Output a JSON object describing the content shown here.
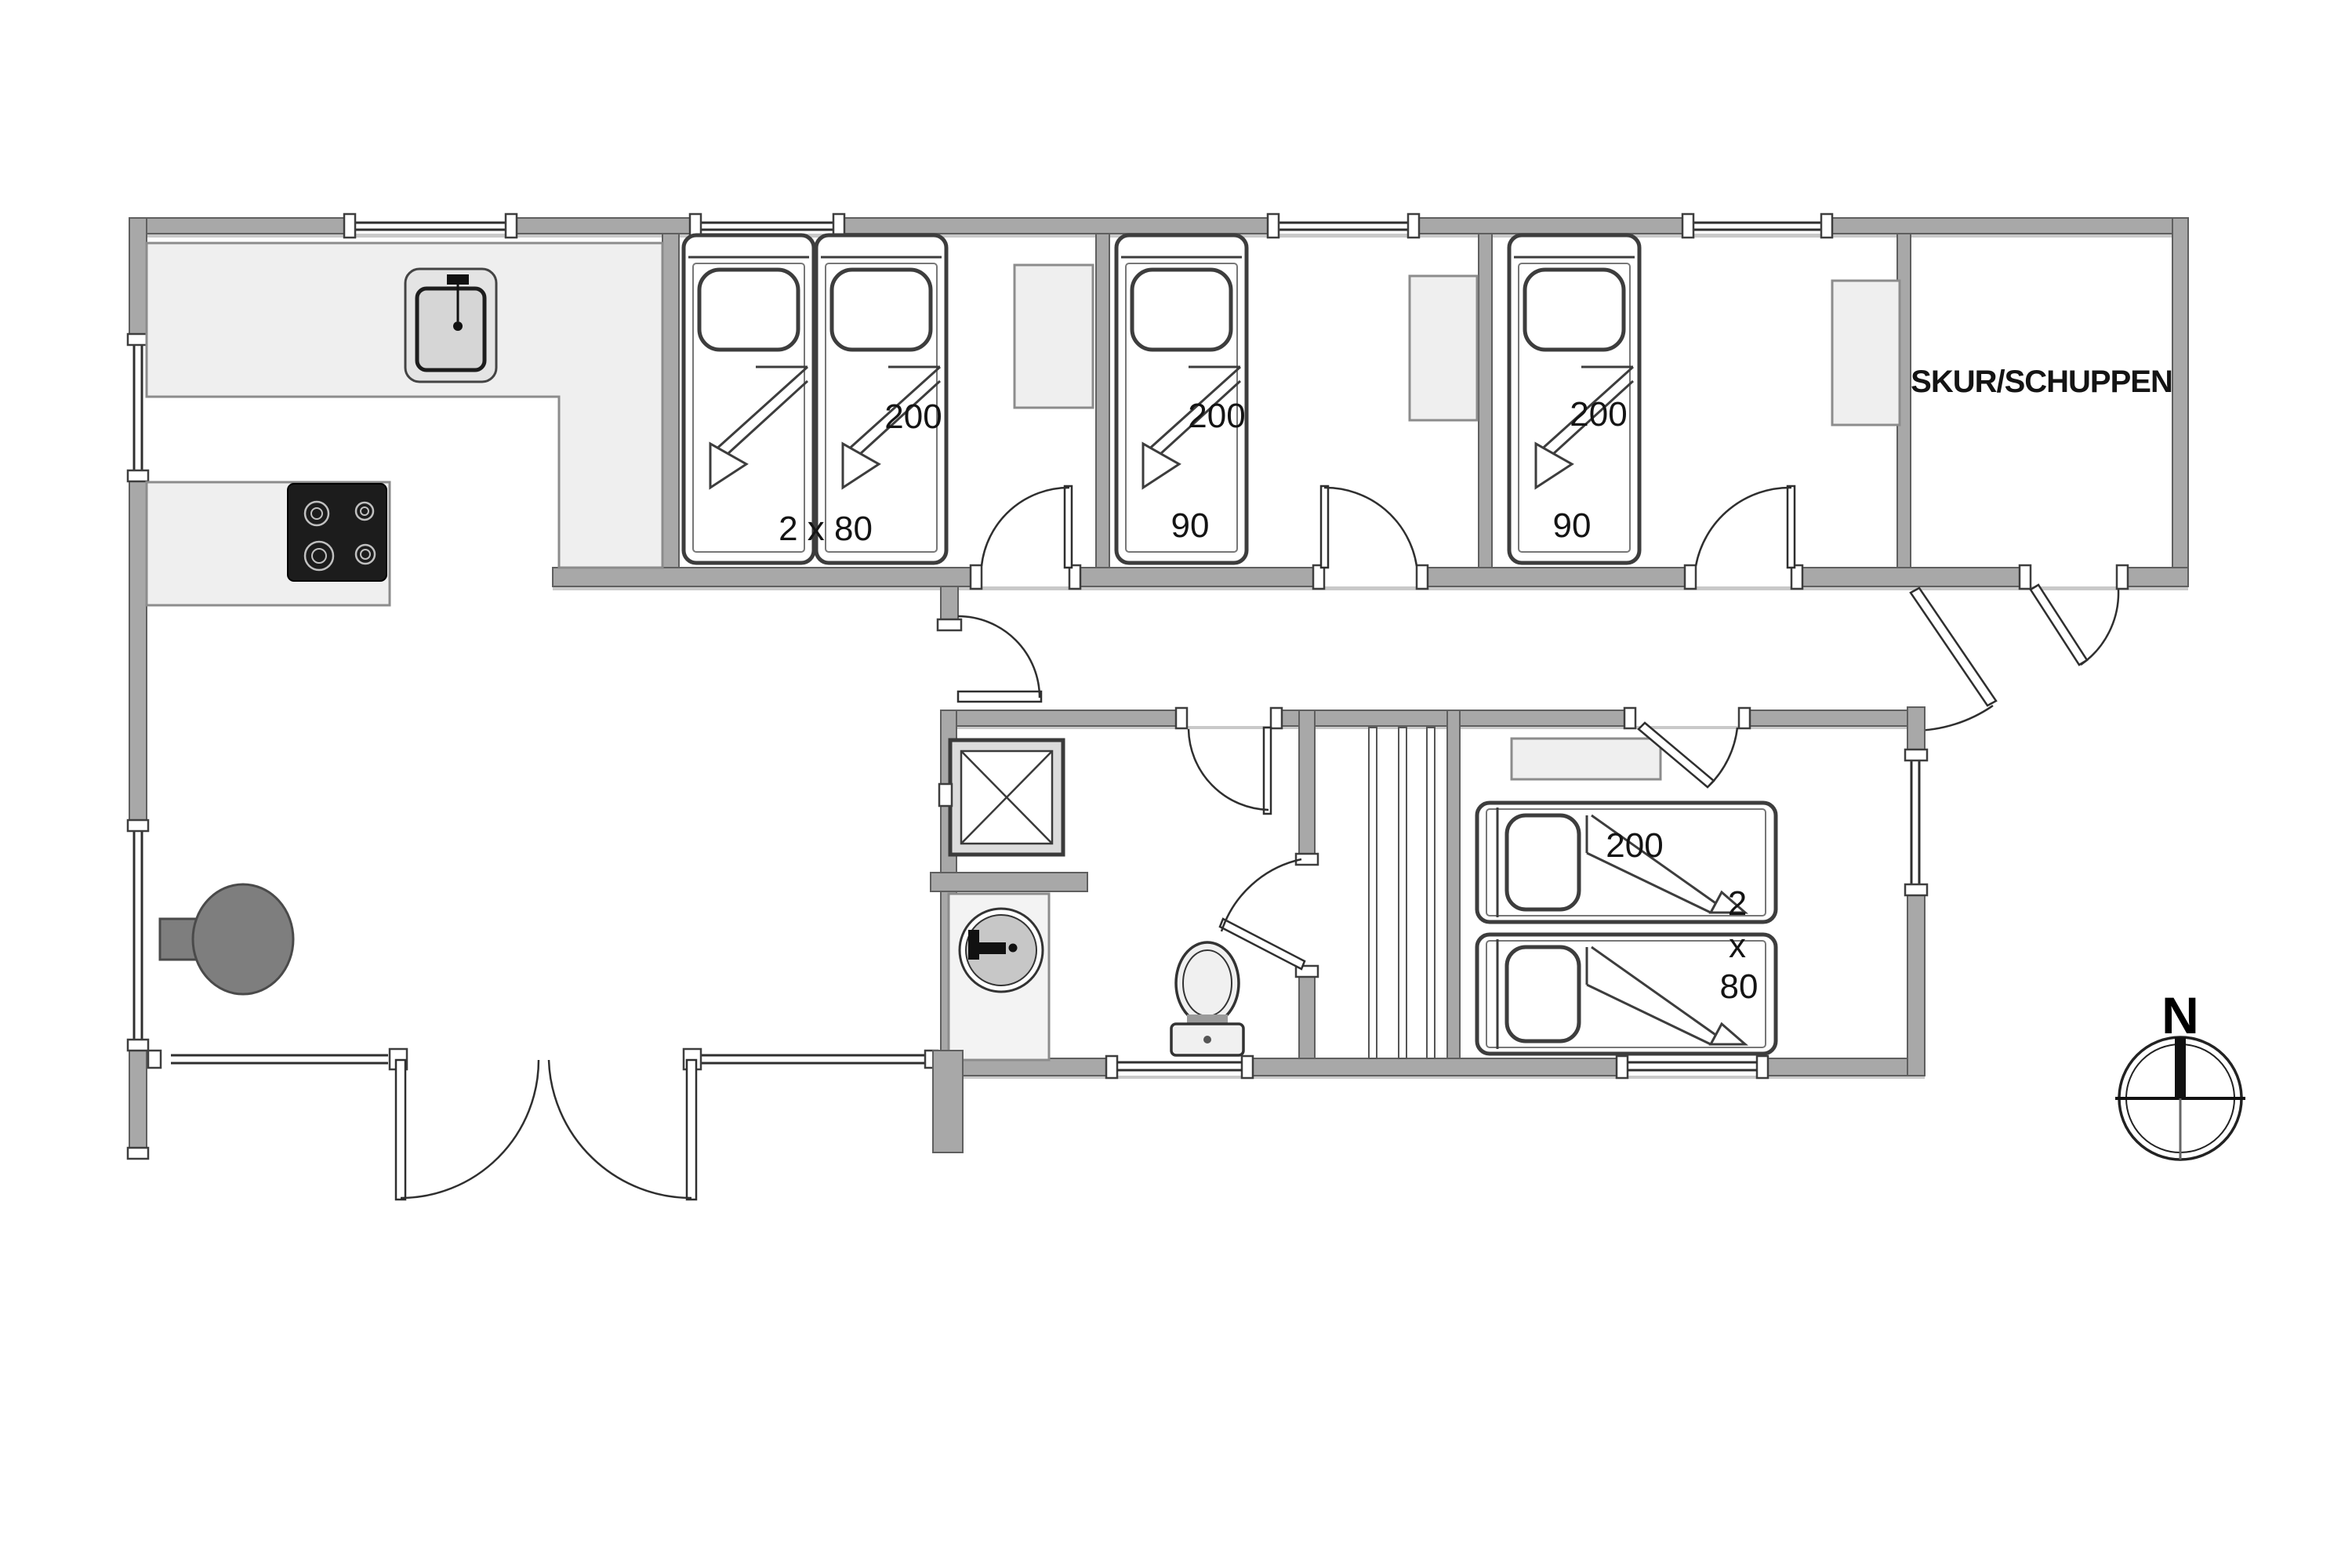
{
  "document": {
    "type": "floor-plan"
  },
  "colors": {
    "wall": "#a8a8a8",
    "wall_edge": "#5f5f5f",
    "furniture": "#efefef",
    "furniture_edge": "#8c8c8c",
    "label": "#141414",
    "stove": "#1c1c1c",
    "wood_stove": "#7e7e7e",
    "line": "#2f2f2f"
  },
  "labels": {
    "shed": "SKUR/SCHUPPEN",
    "compass_north": "N",
    "bedroom1": {
      "bed_length": "200",
      "bed_size": "2 x 80"
    },
    "bedroom2": {
      "bed_length": "200",
      "bed_size": "90"
    },
    "bedroom3": {
      "bed_length": "200",
      "bed_size": "90"
    },
    "bedroom4": {
      "bed_length": "200",
      "bed_size_line1": "2",
      "bed_size_line2": "x",
      "bed_size_line3": "80"
    }
  }
}
